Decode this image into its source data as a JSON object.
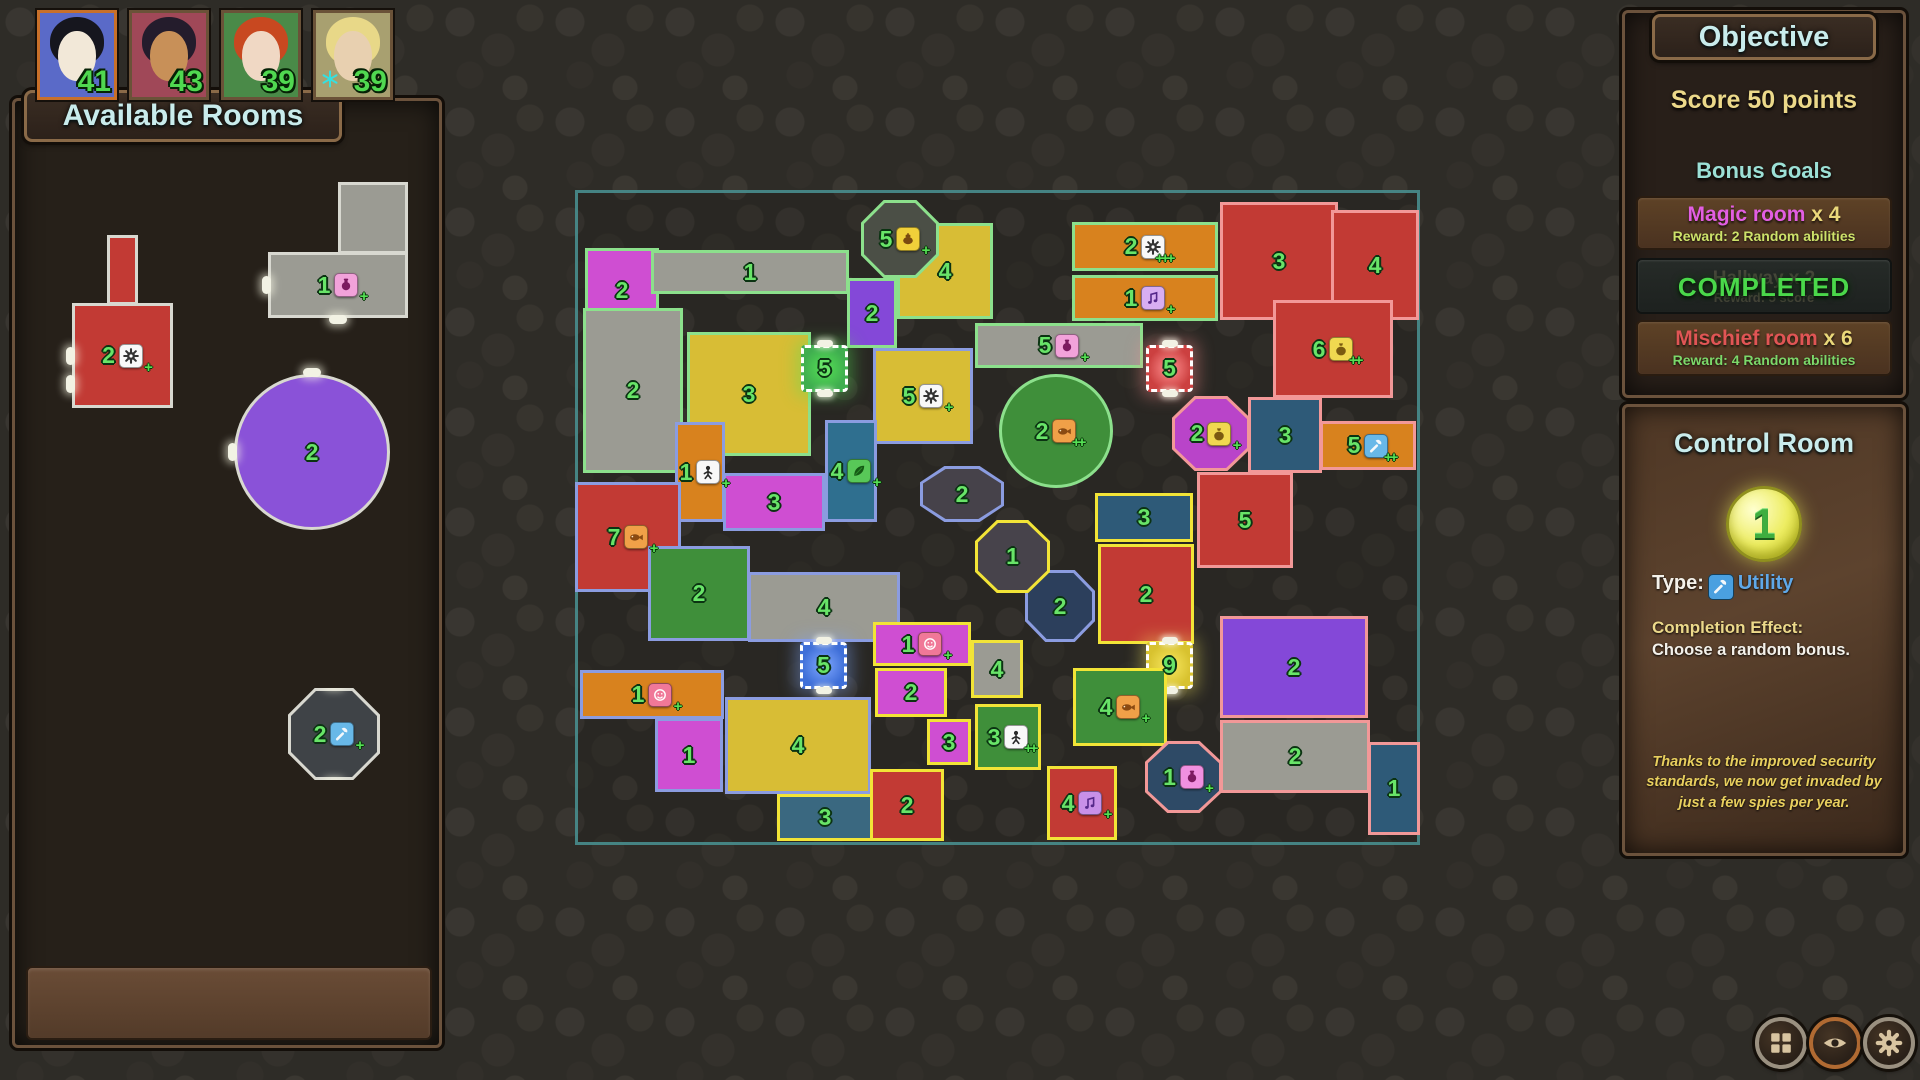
{
  "players": [
    {
      "name": "player-1",
      "score": "41",
      "selected": true,
      "bg": "#5a6ac8",
      "skin": "#f2e8d8",
      "hair": "#16161e"
    },
    {
      "name": "player-2",
      "score": "43",
      "selected": false,
      "bg": "#a04858",
      "skin": "#c89058",
      "hair": "#241c2c"
    },
    {
      "name": "player-3",
      "score": "39",
      "selected": false,
      "bg": "#4a8a48",
      "skin": "#f0d8c4",
      "hair": "#c84820"
    },
    {
      "name": "player-4",
      "score": "39",
      "selected": false,
      "bg": "#a8a070",
      "skin": "#e8d0b0",
      "hair": "#e8d888",
      "badge": "snowflake-icon"
    }
  ],
  "sidebar": {
    "title": "Available Rooms",
    "rooms": [
      {
        "name": "available-room-red-gear",
        "num": "2",
        "fill": "#c23a34",
        "icon": "gear-icon",
        "icon_bg": "#f8f8f8",
        "plus": 1,
        "x": 72,
        "y": 303,
        "w": 101,
        "h": 105,
        "stem": {
          "x": 107,
          "y": 235,
          "w": 31,
          "h": 70
        },
        "nubs": [
          "left",
          "bottomleft"
        ]
      },
      {
        "name": "available-room-gray-hall",
        "num": "1",
        "fill": "#9b9b93",
        "icon": "potion-icon",
        "icon_bg": "#f2a2da",
        "plus": 1,
        "x": 268,
        "y": 252,
        "w": 140,
        "h": 66,
        "stem": {
          "x": 338,
          "y": 182,
          "w": 70,
          "h": 72
        },
        "nubs": [
          "left",
          "bottom"
        ]
      },
      {
        "name": "available-room-purple-lounge",
        "num": "2",
        "fill": "#8a52d8",
        "shape": "circ",
        "x": 234,
        "y": 374,
        "w": 156,
        "h": 156,
        "nubs": [
          "top",
          "left"
        ]
      },
      {
        "name": "available-room-utility-octagon",
        "num": "2",
        "fill": "#3f4347",
        "icon": "wrench-icon",
        "icon_bg": "#68b8e8",
        "plus": 1,
        "shape": "oct",
        "x": 288,
        "y": 688,
        "w": 92,
        "h": 92,
        "nubs": [
          "top",
          "bottom"
        ]
      }
    ]
  },
  "map": {
    "x": 575,
    "y": 190,
    "w": 845,
    "h": 655,
    "team_colors": {
      "green": "#8ce08c",
      "blue": "#8b9ce0",
      "yellow": "#f2e437",
      "red": "#f29898",
      "neutral": "#d8d8d0"
    },
    "rooms": [
      {
        "t": "green",
        "x": 10,
        "y": 58,
        "w": 74,
        "h": 84,
        "f": "#cf4ed2",
        "num": "2"
      },
      {
        "t": "green",
        "x": 76,
        "y": 60,
        "w": 198,
        "h": 44,
        "f": "#9b9b93",
        "num": "1"
      },
      {
        "t": "green",
        "x": 322,
        "y": 33,
        "w": 96,
        "h": 96,
        "f": "#d8bd35",
        "num": "4"
      },
      {
        "t": "green",
        "x": 286,
        "y": 10,
        "w": 78,
        "h": 78,
        "f": "#4b4f46",
        "num": "5",
        "icon": "magic-lamp-icon",
        "ib": "#f0d03a",
        "p": 1,
        "s": "oct"
      },
      {
        "t": "green",
        "x": 272,
        "y": 88,
        "w": 50,
        "h": 70,
        "f": "#8448d8",
        "num": "2"
      },
      {
        "t": "green",
        "x": 8,
        "y": 118,
        "w": 100,
        "h": 165,
        "f": "#9b9b93",
        "num": "2"
      },
      {
        "t": "green",
        "x": 112,
        "y": 142,
        "w": 124,
        "h": 124,
        "f": "#d8bd35",
        "num": "3"
      },
      {
        "t": "green",
        "x": 226,
        "y": 155,
        "w": 47,
        "h": 47,
        "f": "#3fae4f",
        "num": "5",
        "s": "dash",
        "glow": "#55e055"
      },
      {
        "t": "green",
        "x": 497,
        "y": 32,
        "w": 146,
        "h": 49,
        "f": "#d8821e",
        "num": "2",
        "icon": "gear-icon",
        "ib": "#f8f8f8",
        "p": 3
      },
      {
        "t": "green",
        "x": 497,
        "y": 85,
        "w": 146,
        "h": 46,
        "f": "#d8821e",
        "num": "1",
        "icon": "music-note-icon",
        "ib": "#d8aef2",
        "p": 1
      },
      {
        "t": "green",
        "x": 400,
        "y": 133,
        "w": 168,
        "h": 45,
        "f": "#9b9b93",
        "num": "5",
        "icon": "potion-icon",
        "ib": "#f2a2da",
        "p": 1
      },
      {
        "t": "green",
        "x": 424,
        "y": 184,
        "w": 114,
        "h": 114,
        "f": "#3f8f3a",
        "num": "2",
        "icon": "fish-icon",
        "ib": "#f0a048",
        "p": 2,
        "s": "circ"
      },
      {
        "t": "blue",
        "x": 298,
        "y": 158,
        "w": 100,
        "h": 96,
        "f": "#d8bd35",
        "num": "5",
        "icon": "gear-icon",
        "ib": "#f8f8f8",
        "p": 1
      },
      {
        "t": "blue",
        "x": 250,
        "y": 230,
        "w": 52,
        "h": 102,
        "f": "#2f6f8f",
        "num": "4",
        "icon": "leaf-icon",
        "ib": "#58c858",
        "p": 1
      },
      {
        "t": "blue",
        "x": 100,
        "y": 232,
        "w": 50,
        "h": 100,
        "f": "#d8821e",
        "num": "1",
        "icon": "person-icon",
        "ib": "#f8f8f8",
        "p": 1
      },
      {
        "t": "blue",
        "x": 148,
        "y": 283,
        "w": 102,
        "h": 58,
        "f": "#cf4ed2",
        "num": "3"
      },
      {
        "t": "blue",
        "x": 0,
        "y": 292,
        "w": 106,
        "h": 110,
        "f": "#c23a34",
        "num": "7",
        "icon": "fish-icon",
        "ib": "#f0a048",
        "p": 1
      },
      {
        "t": "blue",
        "x": 73,
        "y": 356,
        "w": 102,
        "h": 95,
        "f": "#3f8f3a",
        "num": "2"
      },
      {
        "t": "blue",
        "x": 173,
        "y": 382,
        "w": 152,
        "h": 70,
        "f": "#9b9b93",
        "num": "4"
      },
      {
        "t": "blue",
        "x": 225,
        "y": 452,
        "w": 47,
        "h": 47,
        "f": "#3f6fd8",
        "num": "5",
        "s": "dash",
        "glow": "#80a8ff"
      },
      {
        "t": "blue",
        "x": 5,
        "y": 480,
        "w": 144,
        "h": 49,
        "f": "#d8821e",
        "num": "1",
        "icon": "smiley-icon",
        "ib": "#f07898",
        "p": 1
      },
      {
        "t": "blue",
        "x": 80,
        "y": 528,
        "w": 68,
        "h": 74,
        "f": "#cf4ed2",
        "num": "1"
      },
      {
        "t": "blue",
        "x": 150,
        "y": 507,
        "w": 146,
        "h": 97,
        "f": "#d8bd35",
        "num": "4"
      },
      {
        "t": "blue",
        "x": 345,
        "y": 276,
        "w": 84,
        "h": 56,
        "f": "#46424a",
        "num": "2",
        "s": "oct"
      },
      {
        "t": "blue",
        "x": 450,
        "y": 380,
        "w": 70,
        "h": 72,
        "f": "#2c3f5c",
        "num": "2",
        "s": "oct"
      },
      {
        "t": "yellow",
        "x": 202,
        "y": 604,
        "w": 96,
        "h": 47,
        "f": "#3a6880",
        "num": "3"
      },
      {
        "t": "yellow",
        "x": 400,
        "y": 330,
        "w": 75,
        "h": 73,
        "f": "#47434b",
        "num": "1",
        "s": "oct"
      },
      {
        "t": "yellow",
        "x": 520,
        "y": 303,
        "w": 98,
        "h": 49,
        "f": "#2e5a78",
        "num": "3"
      },
      {
        "t": "yellow",
        "x": 523,
        "y": 354,
        "w": 96,
        "h": 100,
        "f": "#c23a34",
        "num": "2"
      },
      {
        "t": "yellow",
        "x": 571,
        "y": 452,
        "w": 47,
        "h": 47,
        "f": "#d8c22f",
        "num": "9",
        "s": "dash",
        "glow": "#f8e860"
      },
      {
        "t": "yellow",
        "x": 498,
        "y": 478,
        "w": 94,
        "h": 78,
        "f": "#3f8f3a",
        "num": "4",
        "icon": "fish-icon",
        "ib": "#f0a048",
        "p": 1
      },
      {
        "t": "yellow",
        "x": 400,
        "y": 514,
        "w": 66,
        "h": 66,
        "f": "#3f8f3a",
        "num": "3",
        "icon": "person-icon",
        "ib": "#f8f8f8",
        "p": 2
      },
      {
        "t": "yellow",
        "x": 472,
        "y": 576,
        "w": 70,
        "h": 74,
        "f": "#c23a34",
        "num": "4",
        "icon": "music-note-icon",
        "ib": "#c890e8",
        "p": 1
      },
      {
        "t": "yellow",
        "x": 295,
        "y": 579,
        "w": 74,
        "h": 72,
        "f": "#c23a34",
        "num": "2"
      },
      {
        "t": "yellow",
        "x": 298,
        "y": 432,
        "w": 98,
        "h": 44,
        "f": "#cf4ed2",
        "num": "1",
        "icon": "smiley-icon",
        "ib": "#f07898",
        "p": 1
      },
      {
        "t": "yellow",
        "x": 300,
        "y": 478,
        "w": 72,
        "h": 49,
        "f": "#cf4ed2",
        "num": "2"
      },
      {
        "t": "yellow",
        "x": 352,
        "y": 529,
        "w": 44,
        "h": 46,
        "f": "#cf4ed2",
        "num": "3"
      },
      {
        "t": "yellow",
        "x": 396,
        "y": 450,
        "w": 52,
        "h": 58,
        "f": "#9b9b93",
        "num": "4"
      },
      {
        "t": "red",
        "x": 645,
        "y": 12,
        "w": 118,
        "h": 118,
        "f": "#c23a34",
        "num": "3"
      },
      {
        "t": "red",
        "x": 756,
        "y": 20,
        "w": 88,
        "h": 110,
        "f": "#c23a34",
        "num": "4"
      },
      {
        "t": "red",
        "x": 698,
        "y": 110,
        "w": 120,
        "h": 98,
        "f": "#c23a34",
        "num": "6",
        "icon": "moneybag-icon",
        "ib": "#f0d850",
        "p": 2
      },
      {
        "t": "red",
        "x": 571,
        "y": 155,
        "w": 47,
        "h": 47,
        "f": "#cc4040",
        "num": "5",
        "s": "dash",
        "glow": "#ff9090"
      },
      {
        "t": "red",
        "x": 597,
        "y": 206,
        "w": 78,
        "h": 75,
        "f": "#b944c9",
        "num": "2",
        "icon": "moneybag-icon",
        "ib": "#f0d850",
        "p": 1,
        "s": "oct"
      },
      {
        "t": "red",
        "x": 673,
        "y": 207,
        "w": 74,
        "h": 76,
        "f": "#2e5a78",
        "num": "3"
      },
      {
        "t": "red",
        "x": 745,
        "y": 231,
        "w": 96,
        "h": 49,
        "f": "#d8821e",
        "num": "5",
        "icon": "wrench-icon",
        "ib": "#68b8e8",
        "p": 2
      },
      {
        "t": "red",
        "x": 622,
        "y": 282,
        "w": 96,
        "h": 96,
        "f": "#c23a34",
        "num": "5"
      },
      {
        "t": "red",
        "x": 645,
        "y": 426,
        "w": 148,
        "h": 102,
        "f": "#8448d8",
        "num": "2"
      },
      {
        "t": "red",
        "x": 645,
        "y": 530,
        "w": 150,
        "h": 73,
        "f": "#9b9b93",
        "num": "2"
      },
      {
        "t": "red",
        "x": 570,
        "y": 551,
        "w": 77,
        "h": 72,
        "f": "#2e4a66",
        "num": "1",
        "icon": "potion-icon",
        "ib": "#f090e0",
        "p": 1,
        "s": "oct"
      },
      {
        "t": "red",
        "x": 793,
        "y": 552,
        "w": 52,
        "h": 93,
        "f": "#2e5a78",
        "num": "1"
      }
    ]
  },
  "objective": {
    "title": "Objective",
    "main_goal": "Score 50 points",
    "bonus_header": "Bonus Goals",
    "goals": [
      {
        "label": "Magic room",
        "count": "x 4",
        "label_color": "#e25ee2",
        "reward": "Reward: 2 Random abilities",
        "reward_color": "#cde26a",
        "completed": false
      },
      {
        "label": "Hallway",
        "count": "x 2",
        "reward": "Reward: 5 score",
        "completed": true,
        "completed_label": "COMPLETED"
      },
      {
        "label": "Mischief room",
        "count": "x 6",
        "label_color": "#e05555",
        "reward": "Reward: 4 Random abilities",
        "reward_color": "#7cd86a",
        "completed": false
      }
    ]
  },
  "inspector": {
    "title": "Control Room",
    "value": "1",
    "type_label": "Type:",
    "type_icon": "wrench-icon",
    "type_value": "Utility",
    "effect_label": "Completion Effect:",
    "effect_text": "Choose a random bonus.",
    "flavor": "Thanks to the improved security standards, we now get invaded by just a few spies per year."
  },
  "toolbar": {
    "buttons": [
      {
        "name": "layout-button",
        "icon": "grid-icon",
        "ring": "#9a9080"
      },
      {
        "name": "visibility-button",
        "icon": "eye-icon",
        "ring": "#b06a32"
      },
      {
        "name": "settings-button",
        "icon": "gear-tan-icon",
        "ring": "#9a9080"
      }
    ]
  }
}
